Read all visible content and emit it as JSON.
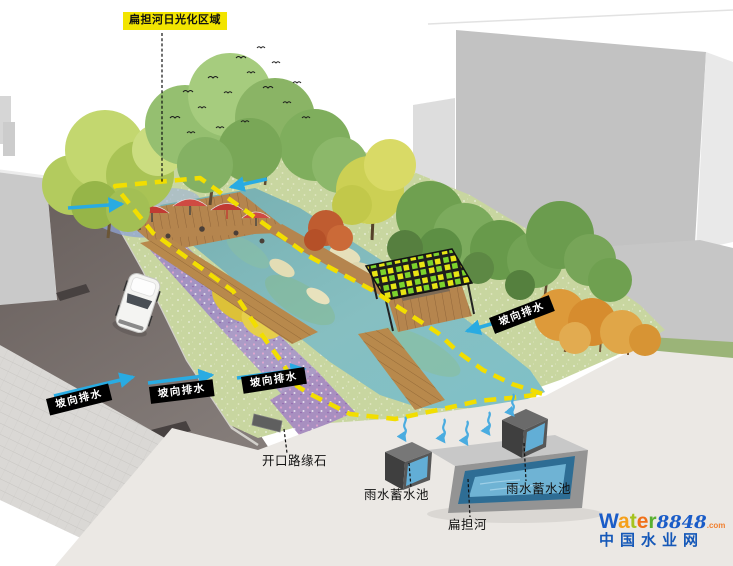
{
  "scene": {
    "title_label": "扁担河日光化区域",
    "annotations": {
      "drainage": [
        "坡向排水",
        "坡向排水",
        "坡向排水",
        "坡向排水"
      ],
      "curb": "开口路缘石",
      "tank_left": "雨水蓄水池",
      "tank_right": "雨水蓄水池",
      "river": "扁担河"
    }
  },
  "logo": {
    "letters": [
      {
        "char": "W",
        "color": "#1a5cc8"
      },
      {
        "char": "a",
        "color": "#f5a01a"
      },
      {
        "char": "t",
        "color": "#a6c31e"
      },
      {
        "char": "e",
        "color": "#f07018"
      },
      {
        "char": "r",
        "color": "#58b030"
      }
    ],
    "number": "8848",
    "number_color": "#1a5cc8",
    "tld": ".com",
    "tld_color": "#f08030",
    "subtitle": "中国水业网",
    "subtitle_color": "#1558b8"
  },
  "colors": {
    "arrow_blue": "#29abe2",
    "infiltration_arrow_blue": "#4aace0",
    "boundary_yellow": "#f2de00",
    "drainage_label_bg": "#000000",
    "drainage_label_text": "#ffffff",
    "title_bg": "#f2e400",
    "water": "#7fb8ba",
    "tank_water": "#62aed6",
    "road": "#6e6562",
    "building": "#c4c4c4",
    "meadow": "#c8d6a0"
  }
}
